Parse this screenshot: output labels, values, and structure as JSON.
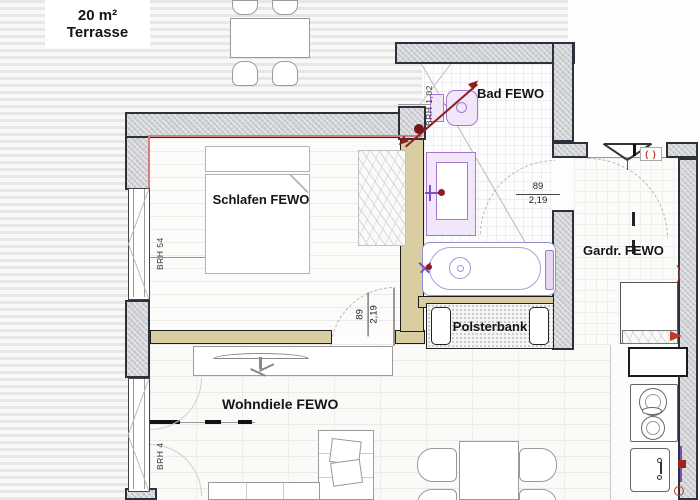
{
  "terrace": {
    "area": "20 m²",
    "name": "Terrasse"
  },
  "rooms": {
    "bedroom": "Schlafen FEWO",
    "bath": "Bad FEWO",
    "wardrobe": "Gardr. FEWO",
    "living": "Wohndiele FEWO"
  },
  "furniture": {
    "bench": "Polsterbank"
  },
  "dimensions": {
    "bedroom_window_sill": "BRH 54",
    "living_window_sill": "BRH 4",
    "bath_window_sill": "BRH 1,02",
    "bath_door": {
      "width": "89",
      "height": "2,19"
    },
    "bedroom_door": {
      "width": "89",
      "height": "2,19"
    }
  },
  "symbols": {
    "entry_vent": "( )"
  },
  "colors": {
    "fixture_purple": "#a678cf",
    "drain_red": "#8f1d1d",
    "accent_red": "#c0392b",
    "wall_dark": "#2c313c",
    "wall_tan": "#d9cda2",
    "heating_line": "#d47f7f"
  }
}
